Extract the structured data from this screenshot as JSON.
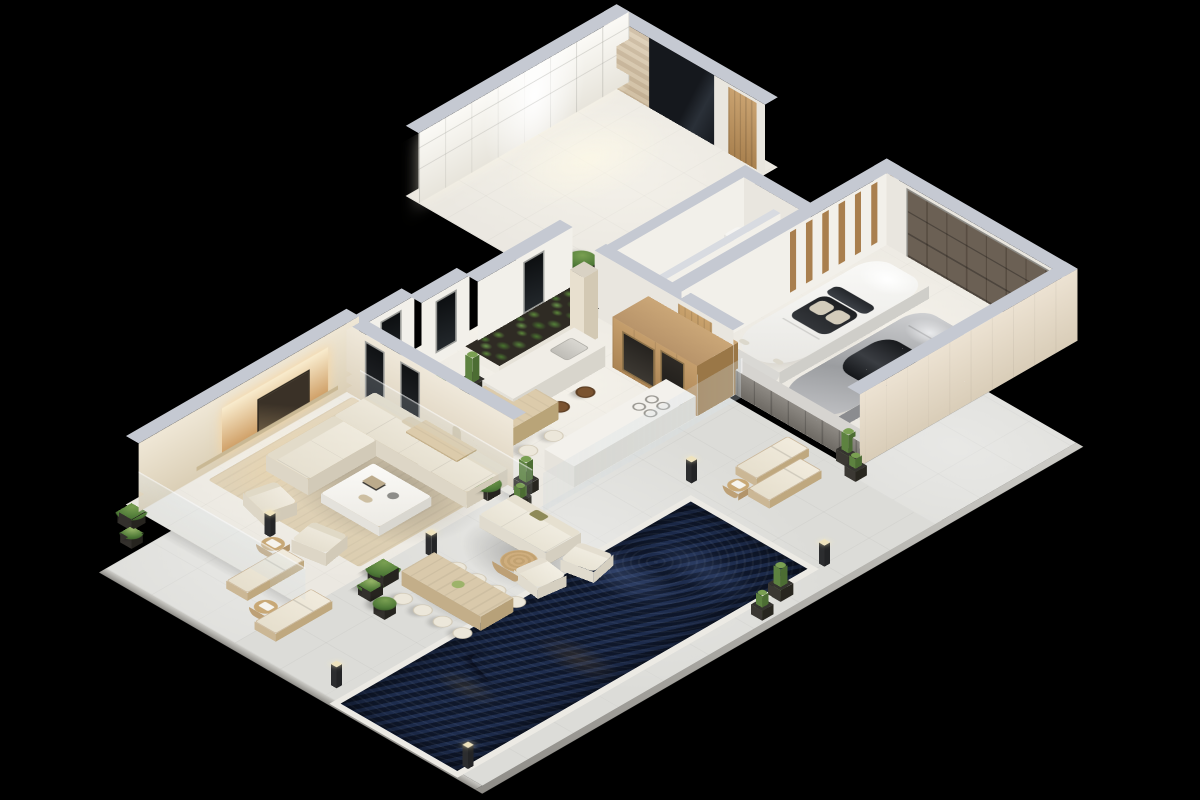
{
  "scene": {
    "label": "3D isometric cutaway floor plan render of a modern luxury villa with pool, garage and terraces on a black backdrop",
    "projection": "isometric, plan rotated 45 degrees",
    "background": "#000000"
  },
  "palette": {
    "bg": "#000000",
    "terrace": "#dcdcd8",
    "terrace-edge": "#cdccc7",
    "floor": "#ebe8e1",
    "floor-warm": "#efe9df",
    "rug": "#e0d3ba",
    "cap": "#c5c9d2",
    "face": "#f2f0ea",
    "facem": "#e9e6df",
    "beige": "#e7dcc9",
    "wood": "#c69f6e",
    "wood-dark": "#7d5f3f",
    "door": "#5f5449",
    "stone": "#8b867f",
    "soil": "#2f2b24",
    "leaf": "#4f7a38",
    "leaf-hi": "#7aa052",
    "cactus": "#6a8f4f",
    "pool-deep": "#141f38",
    "pool-mid": "#22355a",
    "cream": "#ece6d8",
    "car-white": "#f5f4f1",
    "car-silver": "#b7b8ba",
    "glow": "#fff6e0"
  },
  "rooms": {
    "entry": {
      "label": "Entry foyer with backlit walk-in wardrobe",
      "items": [
        "glowing glass-front wardrobe cabinets",
        "dark mirror panel",
        "travertine stone accent",
        "wood panel door"
      ]
    },
    "stairs": {
      "label": "Staircase to lower court"
    },
    "garden": {
      "label": "Indoor planted garden bed"
    },
    "bathroom": {
      "label": "Bathroom",
      "items": [
        "sink",
        "toilet"
      ]
    },
    "laundry": {
      "label": "Laundry room",
      "items": [
        "washing machine"
      ]
    },
    "garage": {
      "label": "Two-car garage",
      "items": [
        "slatted sectional garage door",
        "wood slat feature wall",
        "white convertible sports car",
        "silver sports coupe"
      ]
    },
    "kitchen": {
      "label": "Kitchen",
      "items": [
        "wood cabinet wall with built-in appliances",
        "stone counter with cooktop",
        "island with sink",
        "two bar chairs",
        "stone column"
      ]
    },
    "dining": {
      "label": "Dining area",
      "items": [
        "long wood dining table",
        "10 white chairs"
      ]
    },
    "living": {
      "label": "Living room",
      "items": [
        "L-shaped cream sectional sofa",
        "square white coffee table",
        "two accent armchairs",
        "backlit art feature wall",
        "area rug"
      ]
    }
  },
  "outdoor": {
    "terrace": {
      "label": "Travertine pool terrace"
    },
    "pool": {
      "label": "Long rectangular swimming pool",
      "water": "dark indigo with ripple reflections",
      "float": "white inflatable pool lounger"
    },
    "lounge": {
      "label": "Outdoor lounge set",
      "items": [
        "two-seat outdoor sofa",
        "two outdoor armchairs",
        "round rattan coffee table"
      ]
    },
    "dining": {
      "label": "Outdoor dining table with eight chairs"
    },
    "sundeck_left": {
      "label": "Sun deck with two loungers and side tables"
    },
    "sundeck_right": {
      "label": "Sun deck with two loungers near garage"
    },
    "lighting": {
      "label": "Bollard path lights",
      "count": 6
    },
    "planting": {
      "label": "Cacti and shrubs in dark planters",
      "cacti": 8,
      "shrubs": 7
    }
  },
  "vehicles": [
    {
      "label": "White convertible sports car"
    },
    {
      "label": "Silver sports coupe"
    }
  ],
  "counts": {
    "dining_chairs": 10,
    "outdoor_dining_chairs": 8,
    "sun_loungers": 4,
    "bar_stools": 2,
    "cars": 2,
    "pool_floats": 1
  }
}
